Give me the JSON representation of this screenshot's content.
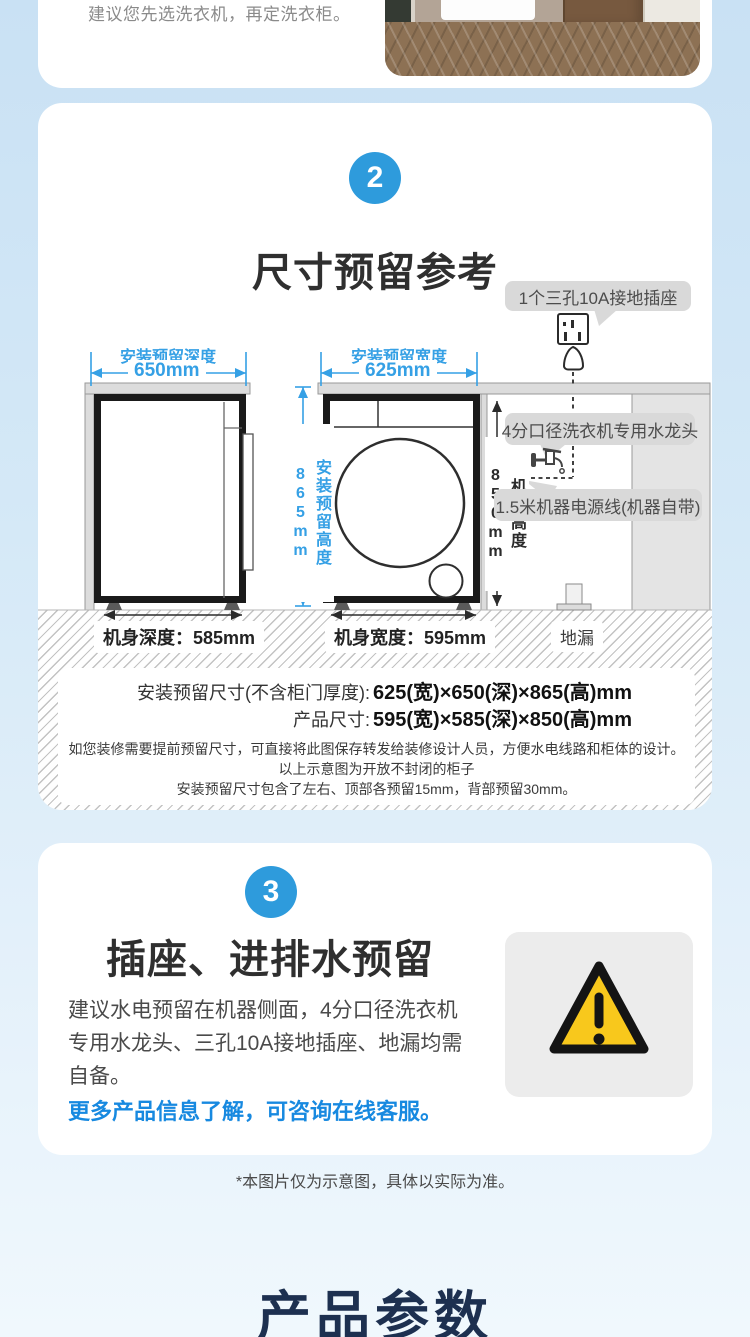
{
  "colors": {
    "accent_blue": "#2e9bdc",
    "dimension_blue": "#35a0e5",
    "link_blue": "#1789e0",
    "warning_yellow": "#f8c81c",
    "callout_gray": "#d9d9d9",
    "heading_navy": "#1d3050"
  },
  "intro_card": {
    "text": "建议您先选洗衣机，再定洗衣柜。"
  },
  "section2": {
    "badge": "2",
    "title": "尺寸预留参考",
    "callouts": {
      "socket": "1个三孔10A接地插座",
      "faucet": "4分口径洗衣机专用水龙头",
      "power": "1.5米机器电源线(机器自带)"
    },
    "dims": {
      "depth_label": "安装预留深度",
      "depth_value": "650mm",
      "width_label": "安装预留宽度",
      "width_value": "625mm",
      "height_label": "安装预留高度865mm",
      "body_height": "机身高度850mm",
      "body_depth": "机身深度：585mm",
      "body_width": "机身宽度：595mm",
      "floor_drain": "地漏"
    },
    "notes": {
      "install_label": "安装预留尺寸(不含柜门厚度):",
      "install_value": "625(宽)×650(深)×865(高)mm",
      "product_label": "产品尺寸:",
      "product_value": "595(宽)×585(深)×850(高)mm",
      "tip1": "如您装修需要提前预留尺寸，可直接将此图保存转发给装修设计人员，方便水电线路和柜体的设计。",
      "tip2": "以上示意图为开放不封闭的柜子",
      "tip3": "安装预留尺寸包含了左右、顶部各预留15mm，背部预留30mm。"
    }
  },
  "section3": {
    "badge": "3",
    "title": "插座、进排水预留",
    "body": "建议水电预留在机器侧面，4分口径洗衣机专用水龙头、三孔10A接地插座、地漏均需自备。",
    "cta": "更多产品信息了解，可咨询在线客服。"
  },
  "footer": {
    "disclaimer": "*本图片仅为示意图，具体以实际为准。",
    "next_section_title": "产品参数"
  },
  "icons": {
    "socket": "socket-icon",
    "plug": "plug-icon",
    "faucet": "faucet-icon",
    "floor_drain": "floor-drain-icon",
    "warning": "warning-triangle-icon"
  }
}
